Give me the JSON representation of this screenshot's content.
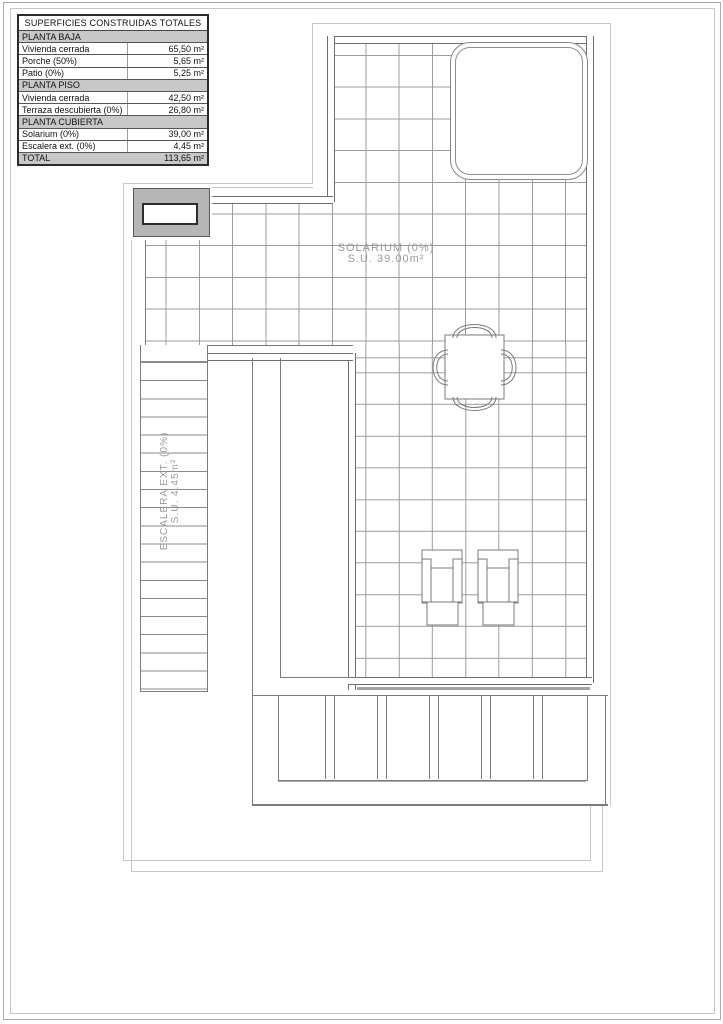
{
  "table": {
    "title": "SUPERFICIES CONSTRUIDAS TOTALES",
    "rows": [
      {
        "label": "PLANTA BAJA",
        "value": ""
      },
      {
        "label": "Vivienda cerrada",
        "value": "65,50 m²"
      },
      {
        "label": "Porche (50%)",
        "value": "5,65 m²"
      },
      {
        "label": "Patio (0%)",
        "value": "5,25 m²"
      },
      {
        "label": "PLANTA PISO",
        "value": ""
      },
      {
        "label": "Vivienda cerrada",
        "value": "42,50 m²"
      },
      {
        "label": "Terraza descubierta (0%)",
        "value": "26,80 m²"
      },
      {
        "label": "PLANTA CUBIERTA",
        "value": ""
      },
      {
        "label": "Solarium (0%)",
        "value": "39,00 m²"
      },
      {
        "label": "Escalera ext. (0%)",
        "value": "4,45 m²"
      },
      {
        "label": "TOTAL",
        "value": "113,65 m²"
      }
    ]
  },
  "plan": {
    "solarium_label": {
      "line1": "SOLARIUM (0%)",
      "line2": "S.U. 39.00m²"
    },
    "escalera_label": {
      "line1": "ESCALERA EXT. (0%)",
      "line2": "S.U. 4.45m²"
    }
  },
  "colors": {
    "wall_line": "#6f6f6f",
    "grid_line": "#9c9c9c",
    "light_outline": "#c6c6c6",
    "chimney_fill": "#b6b6b6",
    "table_section_fill": "#c8c8c8",
    "label_text": "#9a9a9a"
  }
}
